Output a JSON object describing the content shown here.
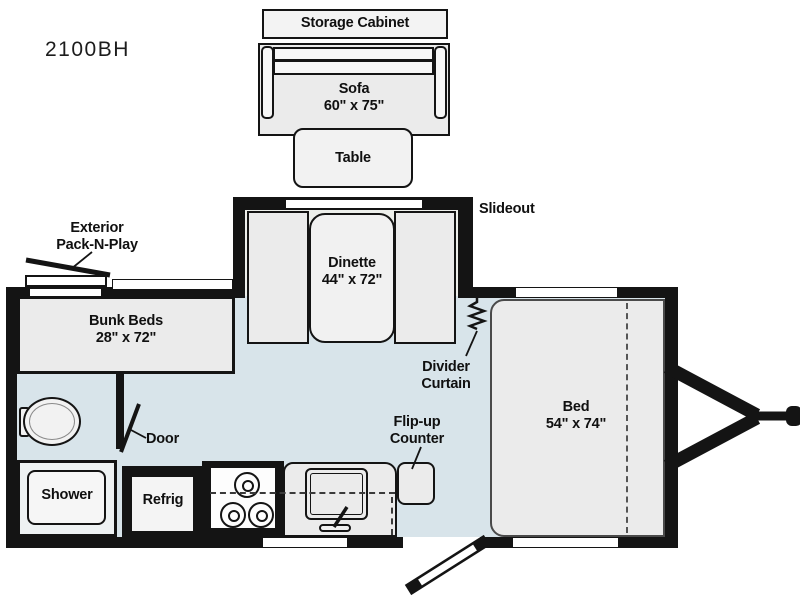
{
  "model": "2100BH",
  "colors": {
    "wall": "#141414",
    "floor": "#d8e4ea",
    "furniture": "#ebebeb",
    "slideout_floor": "#edefeb",
    "white": "#ffffff"
  },
  "labels": {
    "storage_cabinet": "Storage Cabinet",
    "sofa_name": "Sofa",
    "sofa_size": "60\" x 75\"",
    "table": "Table",
    "slideout": "Slideout",
    "dinette_name": "Dinette",
    "dinette_size": "44\" x 72\"",
    "divider_line1": "Divider",
    "divider_line2": "Curtain",
    "packnplay_line1": "Exterior",
    "packnplay_line2": "Pack-N-Play",
    "bunk_name": "Bunk Beds",
    "bunk_size": "28\" x 72\"",
    "door": "Door",
    "shower": "Shower",
    "refrig": "Refrig",
    "flip_line1": "Flip-up",
    "flip_line2": "Counter",
    "bed_name": "Bed",
    "bed_size": "54\" x 74\""
  }
}
